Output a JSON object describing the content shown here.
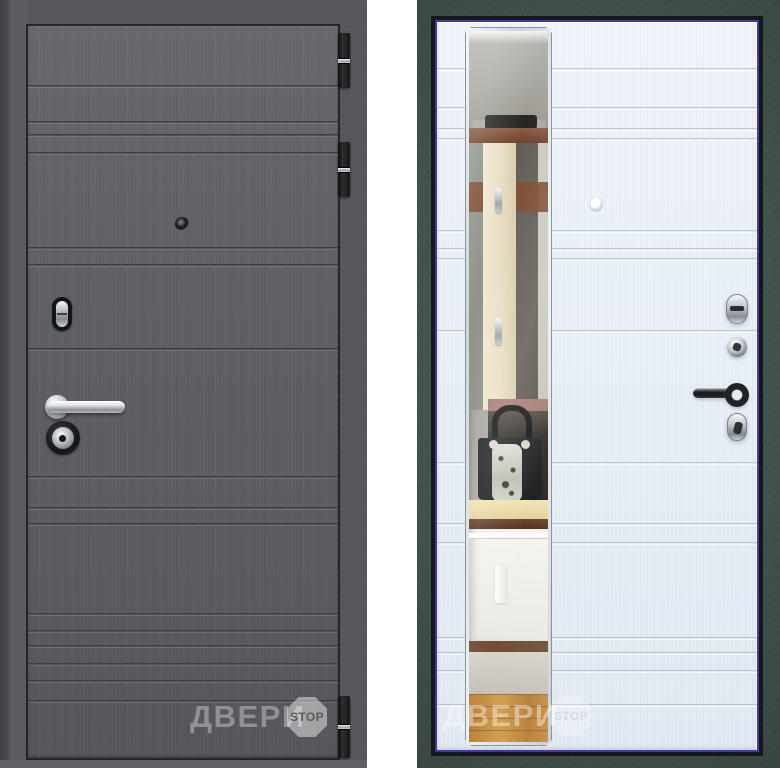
{
  "page": {
    "background_color": "#ffffff",
    "description": "Steel entry door product photos: graphite exterior side (left) and white interior side with full-height mirror (right)"
  },
  "watermark": {
    "brand_text": "ДВЕРИ",
    "badge_text": "STOP"
  },
  "front_view": {
    "label": "front-side-graphite",
    "leaf_color": "#5e6165",
    "frame_color": "#55575a",
    "hinge_count": 3,
    "hardware": [
      "keyhole-escutcheon",
      "lever-handle",
      "lock-cylinder",
      "peephole"
    ]
  },
  "back_view": {
    "label": "interior-side-white-with-mirror",
    "leaf_color": "#eaf0f7",
    "frame_color": "#41504a",
    "edge_accent_color": "#4b35a5",
    "hardware": [
      "thumbturn-escutcheon",
      "lock-knob",
      "lever-handle",
      "cylinder-escutcheon",
      "peephole"
    ],
    "mirror_reflection": [
      "hallway wall",
      "coat rack with hooks",
      "black handbag with scarf",
      "counter",
      "white cabinet",
      "wood floor"
    ]
  }
}
